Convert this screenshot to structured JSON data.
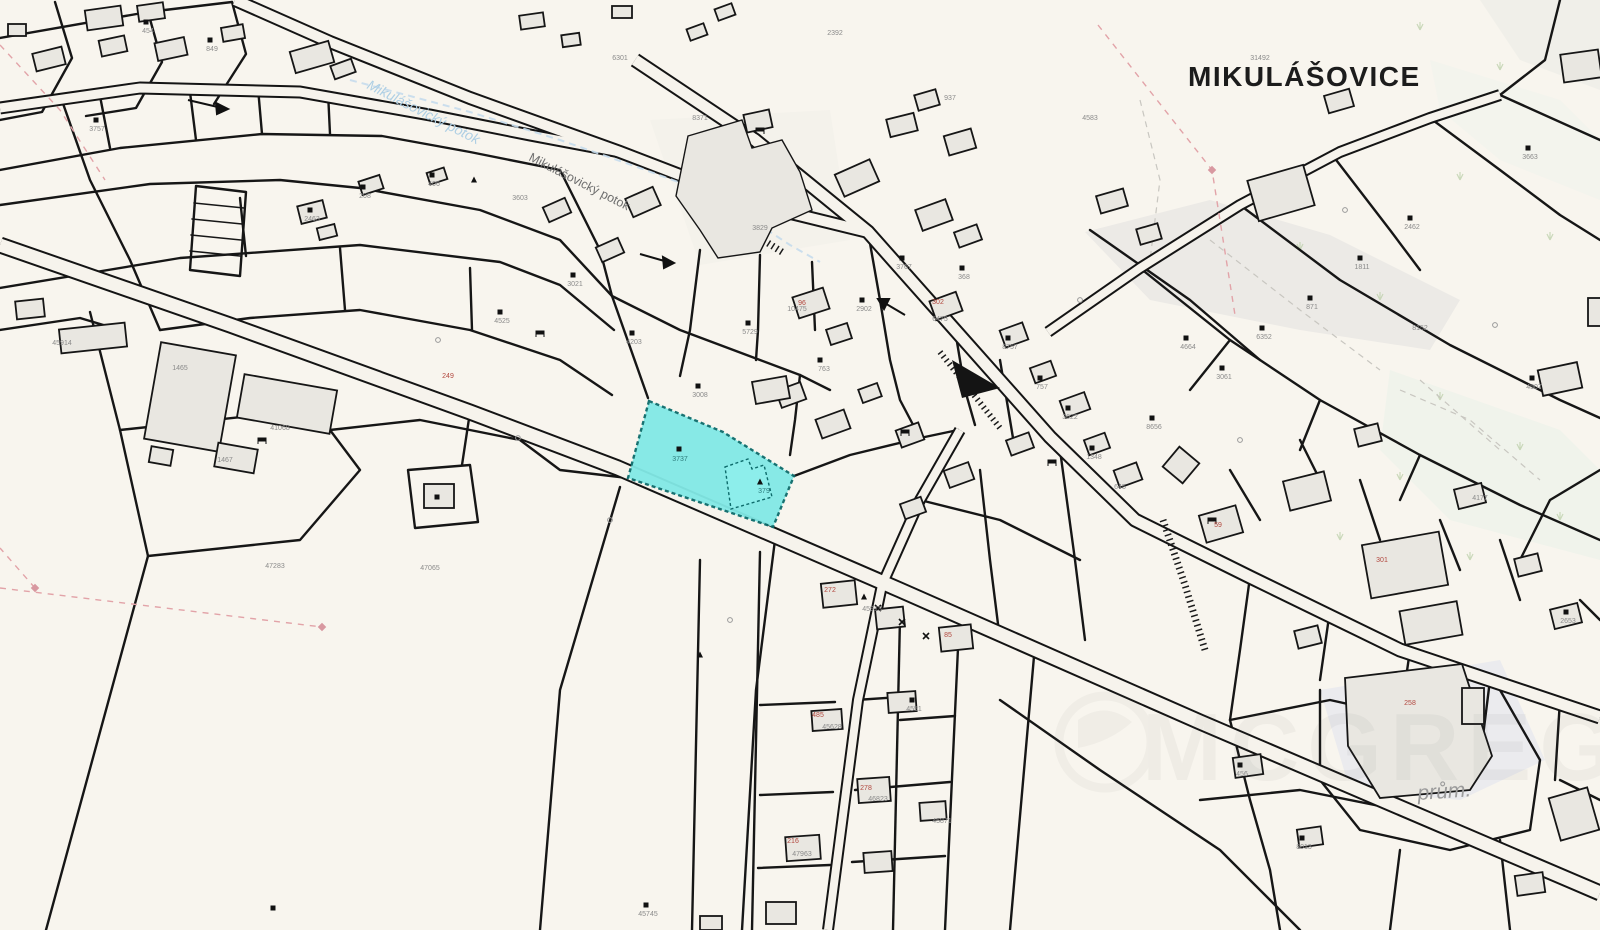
{
  "map": {
    "place_label": "MIKULÁŠOVICE",
    "area_label": "prům.",
    "watermark_text": "MCGREGOR",
    "stream_labels": [
      {
        "text": "Mikulášovický potok",
        "x": 366,
        "y": 88,
        "rot": 27,
        "color": "#aecfe4",
        "size": 14
      },
      {
        "text": "Mikulášovický potok",
        "x": 528,
        "y": 160,
        "rot": 27,
        "color": "#6e6e6e",
        "size": 12.5
      }
    ],
    "highlight_parcel": {
      "parcel_number": "3737",
      "building_number": "379",
      "fill": "#82e9e6",
      "stroke": "#0d6b6b"
    },
    "colors": {
      "background": "#f8f5ee",
      "parcel_line": "#161616",
      "building_fill": "#e9e7e1",
      "road_fill": "#f6f3ec",
      "stream_blue": "#c5dcec",
      "pink_dashed": "#e2a3a8",
      "tree_green": "#c2d3b0",
      "number_gray": "#8a8a8a",
      "number_red": "#b2483f",
      "number_teal": "#2e7d7d"
    },
    "parcel_numbers": [
      {
        "x": 97,
        "y": 131,
        "t": "3757"
      },
      {
        "x": 148,
        "y": 33,
        "t": "454"
      },
      {
        "x": 212,
        "y": 51,
        "t": "849"
      },
      {
        "x": 312,
        "y": 221,
        "t": "2463"
      },
      {
        "x": 365,
        "y": 198,
        "t": "208"
      },
      {
        "x": 434,
        "y": 186,
        "t": "406"
      },
      {
        "x": 502,
        "y": 323,
        "t": "4525"
      },
      {
        "x": 575,
        "y": 286,
        "t": "3021"
      },
      {
        "x": 634,
        "y": 344,
        "t": "4203"
      },
      {
        "x": 700,
        "y": 397,
        "t": "3008"
      },
      {
        "x": 750,
        "y": 334,
        "t": "5729"
      },
      {
        "x": 797,
        "y": 311,
        "t": "10475"
      },
      {
        "x": 824,
        "y": 371,
        "t": "763"
      },
      {
        "x": 864,
        "y": 311,
        "t": "2902"
      },
      {
        "x": 904,
        "y": 269,
        "t": "3767"
      },
      {
        "x": 940,
        "y": 321,
        "t": "6475"
      },
      {
        "x": 964,
        "y": 279,
        "t": "368"
      },
      {
        "x": 1010,
        "y": 349,
        "t": "8757"
      },
      {
        "x": 1042,
        "y": 389,
        "t": "757"
      },
      {
        "x": 1070,
        "y": 419,
        "t": "3622"
      },
      {
        "x": 1094,
        "y": 459,
        "t": "1348"
      },
      {
        "x": 1120,
        "y": 489,
        "t": "645"
      },
      {
        "x": 1154,
        "y": 429,
        "t": "8656"
      },
      {
        "x": 1188,
        "y": 349,
        "t": "4664"
      },
      {
        "x": 1224,
        "y": 379,
        "t": "3061"
      },
      {
        "x": 1264,
        "y": 339,
        "t": "6352"
      },
      {
        "x": 1312,
        "y": 309,
        "t": "871"
      },
      {
        "x": 1362,
        "y": 269,
        "t": "1811"
      },
      {
        "x": 1412,
        "y": 229,
        "t": "2462"
      },
      {
        "x": 1530,
        "y": 159,
        "t": "3663"
      },
      {
        "x": 1534,
        "y": 389,
        "t": "4507"
      },
      {
        "x": 1568,
        "y": 623,
        "t": "2653"
      },
      {
        "x": 1242,
        "y": 776,
        "t": "456"
      },
      {
        "x": 1304,
        "y": 849,
        "t": "8013"
      },
      {
        "x": 872,
        "y": 611,
        "t": "45913"
      },
      {
        "x": 914,
        "y": 711,
        "t": "4551"
      },
      {
        "x": 832,
        "y": 729,
        "t": "45628"
      },
      {
        "x": 878,
        "y": 801,
        "t": "46823"
      },
      {
        "x": 942,
        "y": 823,
        "t": "45871"
      },
      {
        "x": 802,
        "y": 856,
        "t": "47963"
      },
      {
        "x": 275,
        "y": 568,
        "t": "47283"
      },
      {
        "x": 648,
        "y": 916,
        "t": "45745"
      },
      {
        "x": 430,
        "y": 570,
        "t": "47065"
      },
      {
        "x": 180,
        "y": 370,
        "t": "1465"
      },
      {
        "x": 280,
        "y": 430,
        "t": "41068"
      },
      {
        "x": 225,
        "y": 462,
        "t": "1467"
      },
      {
        "x": 62,
        "y": 345,
        "t": "45914"
      },
      {
        "x": 700,
        "y": 120,
        "t": "8371"
      },
      {
        "x": 620,
        "y": 60,
        "t": "6301"
      },
      {
        "x": 835,
        "y": 35,
        "t": "2392"
      },
      {
        "x": 950,
        "y": 100,
        "t": "937"
      },
      {
        "x": 1090,
        "y": 120,
        "t": "4583"
      },
      {
        "x": 1260,
        "y": 60,
        "t": "31492"
      },
      {
        "x": 1420,
        "y": 330,
        "t": "8152"
      },
      {
        "x": 1480,
        "y": 500,
        "t": "4177"
      },
      {
        "x": 520,
        "y": 200,
        "t": "3603"
      },
      {
        "x": 760,
        "y": 230,
        "t": "3829"
      },
      {
        "x": 680,
        "y": 461,
        "t": "3737",
        "c": "#2e7d7d"
      },
      {
        "x": 764,
        "y": 493,
        "t": "379",
        "c": "#2e7d7d"
      },
      {
        "x": 448,
        "y": 378,
        "t": "249",
        "c": "#b2483f"
      },
      {
        "x": 802,
        "y": 305,
        "t": "96",
        "c": "#b2483f"
      },
      {
        "x": 938,
        "y": 304,
        "t": "302",
        "c": "#b2483f"
      },
      {
        "x": 1218,
        "y": 527,
        "t": "59",
        "c": "#b2483f"
      },
      {
        "x": 1382,
        "y": 562,
        "t": "301",
        "c": "#b2483f"
      },
      {
        "x": 830,
        "y": 592,
        "t": "272",
        "c": "#b2483f"
      },
      {
        "x": 948,
        "y": 637,
        "t": "85",
        "c": "#b2483f"
      },
      {
        "x": 818,
        "y": 717,
        "t": "485",
        "c": "#b2483f"
      },
      {
        "x": 866,
        "y": 790,
        "t": "278",
        "c": "#b2483f"
      },
      {
        "x": 793,
        "y": 843,
        "t": "216",
        "c": "#b2483f"
      },
      {
        "x": 1410,
        "y": 705,
        "t": "258",
        "c": "#b2483f"
      }
    ],
    "symbols": [
      {
        "t": "sq",
        "x": 96,
        "y": 120
      },
      {
        "t": "sq",
        "x": 146,
        "y": 22
      },
      {
        "t": "sq",
        "x": 210,
        "y": 40
      },
      {
        "t": "sq",
        "x": 310,
        "y": 210
      },
      {
        "t": "sq",
        "x": 363,
        "y": 187
      },
      {
        "t": "sq",
        "x": 432,
        "y": 175
      },
      {
        "t": "sq",
        "x": 500,
        "y": 312
      },
      {
        "t": "sq",
        "x": 573,
        "y": 275
      },
      {
        "t": "sq",
        "x": 632,
        "y": 333
      },
      {
        "t": "sq",
        "x": 698,
        "y": 386
      },
      {
        "t": "sq",
        "x": 748,
        "y": 323
      },
      {
        "t": "sq",
        "x": 820,
        "y": 360
      },
      {
        "t": "sq",
        "x": 862,
        "y": 300
      },
      {
        "t": "sq",
        "x": 902,
        "y": 258
      },
      {
        "t": "sq",
        "x": 962,
        "y": 268
      },
      {
        "t": "sq",
        "x": 1008,
        "y": 338
      },
      {
        "t": "sq",
        "x": 1040,
        "y": 378
      },
      {
        "t": "sq",
        "x": 1068,
        "y": 408
      },
      {
        "t": "sq",
        "x": 1092,
        "y": 448
      },
      {
        "t": "sq",
        "x": 1152,
        "y": 418
      },
      {
        "t": "sq",
        "x": 1186,
        "y": 338
      },
      {
        "t": "sq",
        "x": 1222,
        "y": 368
      },
      {
        "t": "sq",
        "x": 1262,
        "y": 328
      },
      {
        "t": "sq",
        "x": 1310,
        "y": 298
      },
      {
        "t": "sq",
        "x": 1360,
        "y": 258
      },
      {
        "t": "sq",
        "x": 1410,
        "y": 218
      },
      {
        "t": "sq",
        "x": 1528,
        "y": 148
      },
      {
        "t": "sq",
        "x": 1532,
        "y": 378
      },
      {
        "t": "sq",
        "x": 1566,
        "y": 612
      },
      {
        "t": "sq",
        "x": 1240,
        "y": 765
      },
      {
        "t": "sq",
        "x": 1302,
        "y": 838
      },
      {
        "t": "sq",
        "x": 912,
        "y": 700
      },
      {
        "t": "sq",
        "x": 273,
        "y": 908
      },
      {
        "t": "sq",
        "x": 679,
        "y": 449
      },
      {
        "t": "sq",
        "x": 437,
        "y": 497
      },
      {
        "t": "sq",
        "x": 646,
        "y": 905
      },
      {
        "t": "tri",
        "x": 760,
        "y": 482
      },
      {
        "t": "tri",
        "x": 474,
        "y": 180
      },
      {
        "t": "tri",
        "x": 864,
        "y": 597
      },
      {
        "t": "tri",
        "x": 700,
        "y": 655
      },
      {
        "t": "bench",
        "x": 262,
        "y": 440
      },
      {
        "t": "bench",
        "x": 540,
        "y": 333
      },
      {
        "t": "bench",
        "x": 760,
        "y": 130
      },
      {
        "t": "bench",
        "x": 1052,
        "y": 462
      },
      {
        "t": "bench",
        "x": 1212,
        "y": 520
      },
      {
        "t": "bench",
        "x": 905,
        "y": 432
      },
      {
        "t": "circ",
        "x": 438,
        "y": 340
      },
      {
        "t": "circ",
        "x": 518,
        "y": 438
      },
      {
        "t": "circ",
        "x": 610,
        "y": 520
      },
      {
        "t": "circ",
        "x": 730,
        "y": 620
      },
      {
        "t": "circ",
        "x": 1080,
        "y": 300
      },
      {
        "t": "circ",
        "x": 1345,
        "y": 210
      },
      {
        "t": "circ",
        "x": 1495,
        "y": 325
      },
      {
        "t": "circ",
        "x": 1240,
        "y": 440
      },
      {
        "t": "x",
        "x": 878,
        "y": 608
      },
      {
        "t": "x",
        "x": 902,
        "y": 622
      },
      {
        "t": "x",
        "x": 926,
        "y": 636
      }
    ],
    "trees": [
      {
        "x": 1420,
        "y": 30
      },
      {
        "x": 1500,
        "y": 70
      },
      {
        "x": 1460,
        "y": 180
      },
      {
        "x": 1380,
        "y": 300
      },
      {
        "x": 1440,
        "y": 400
      },
      {
        "x": 1520,
        "y": 450
      },
      {
        "x": 1400,
        "y": 480
      },
      {
        "x": 1340,
        "y": 540
      },
      {
        "x": 1560,
        "y": 520
      },
      {
        "x": 1470,
        "y": 560
      },
      {
        "x": 1300,
        "y": 250
      },
      {
        "x": 1550,
        "y": 240
      }
    ]
  }
}
